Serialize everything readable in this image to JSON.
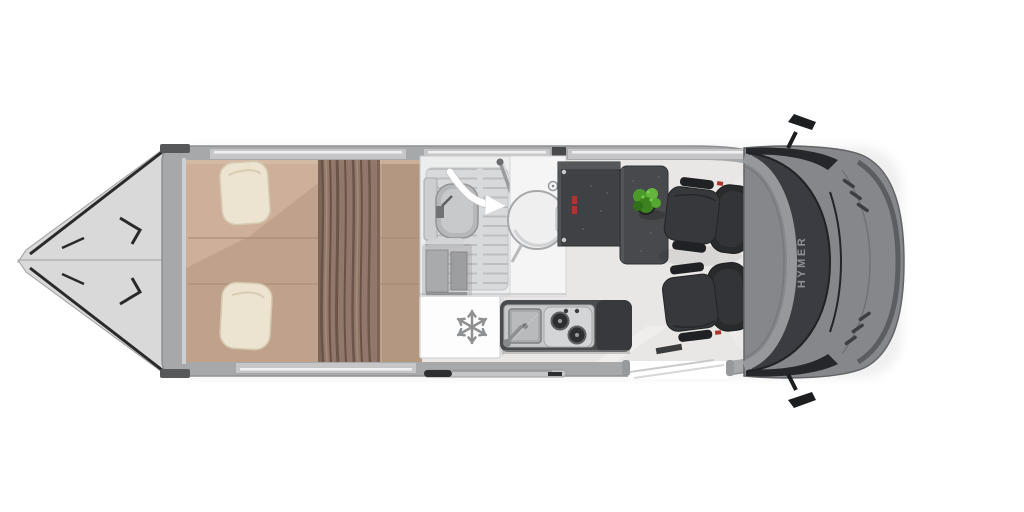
{
  "branding": {
    "windshield_label": "HYMER"
  },
  "icons": [
    "snowflake-icon",
    "swing-door-arrow-icon",
    "faucet-icon",
    "stove-burner-icon"
  ],
  "elements": {
    "vehicle": "campervan-top-view-floorplan",
    "rear": [
      "rear-door-open-top",
      "rear-door-open-bottom"
    ],
    "sleeping": [
      "double-bed",
      "pillow-top",
      "pillow-bottom",
      "divider-curtain"
    ],
    "bathroom": [
      "toilet",
      "shower-floor",
      "swivel-wall",
      "washbasin",
      "swing-door-arrow"
    ],
    "galley": [
      "wardrobe-cabinet",
      "fridge",
      "kitchen-counter",
      "sink",
      "two-burner-stove"
    ],
    "dinette": [
      "sideboard",
      "dining-table",
      "green-plant",
      "swivel-seat-top",
      "swivel-seat-bottom"
    ],
    "cab": [
      "dashboard",
      "windshield",
      "hood",
      "wing-mirror-top",
      "wing-mirror-bottom"
    ],
    "access": [
      "entry-door-opening",
      "sliding-door-rail"
    ]
  },
  "colors": {
    "white": "#ffffff",
    "wall": "#a7a8aa",
    "wallEdge": "#8e8f91",
    "floor": "#e8e7e5",
    "door": "#d9d9d9",
    "doorEdge": "#a0a0a2",
    "seal": "#2a2a2c",
    "mattress": "#c0a28c",
    "mattressHi": "#d6b9a2",
    "mattressLo": "#b2967f",
    "seam": "#a68b76",
    "pillow": "#ece4d0",
    "pillowEdge": "#d4c9af",
    "curtain": "#8f7668",
    "curtainDark": "#5d4a3e",
    "curtainLight": "#a98e7b",
    "bathWhite": "#eceded",
    "showerFloor": "#d8d9db",
    "showerLine": "#bdbec0",
    "fixture": "#b6b7b9",
    "fixtureEdge": "#939496",
    "basin": "#efeff0",
    "cabinet": "#a9aaac",
    "fridge": "#fdfdfd",
    "fridgeEdge": "#d8d9db",
    "iconGray": "#8f9092",
    "steel": "#c7c8ca",
    "sink": "#a9aaac",
    "stove": "#d4d5d7",
    "burner": "#2e2f31",
    "counterDark": "#4a4b4e",
    "counterDarker": "#38393c",
    "furnDark": "#3f4144",
    "tableDark": "#48494c",
    "red": "#ad352c",
    "plant1": "#4c9a2c",
    "plant2": "#63b53b",
    "plant3": "#3c831f",
    "pot": "#222325",
    "seatDark": "#292a2c",
    "seatMid": "#37383b",
    "seatLine": "#202124",
    "dash": "#96989b",
    "windshield": "#3a3c41",
    "hood": "#85878a",
    "hoodEdge": "#626467",
    "trimDark": "#26272a",
    "brandText": "#8e9095",
    "rail": "#c4c5c7",
    "railDark": "#2e2f31"
  }
}
